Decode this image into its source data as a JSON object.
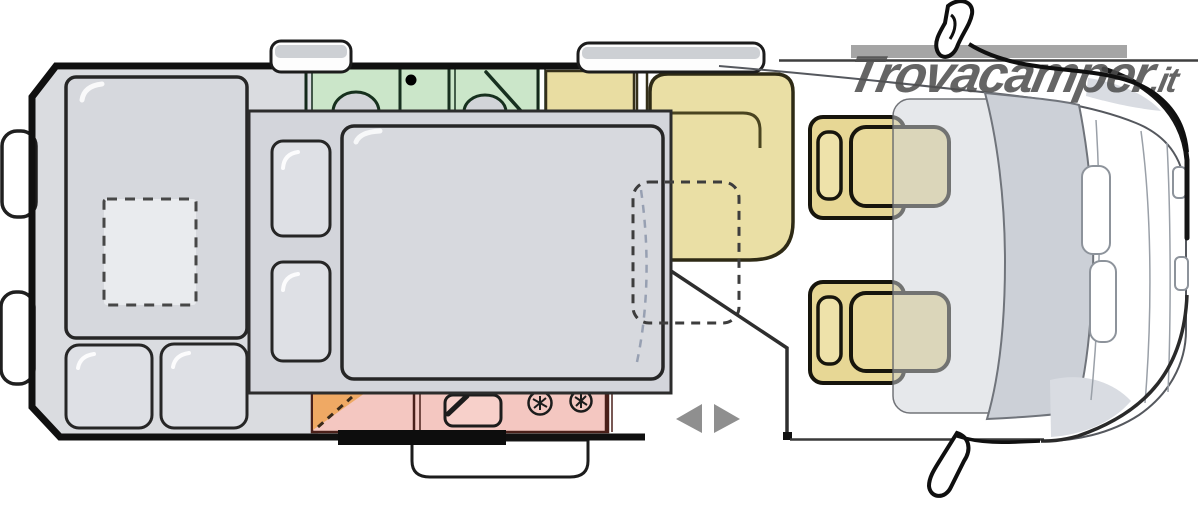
{
  "watermark": {
    "brand": "Trovacamper",
    "suffix": ".it"
  },
  "floorplan": {
    "kind": "motorhome-top-view-floorplan",
    "zones": [
      {
        "id": "rear-bed",
        "name": "rear transverse bed with roof vent"
      },
      {
        "id": "drop-down-bed",
        "name": "drop-down double bed (lowered, shown over living area)"
      },
      {
        "id": "bathroom",
        "name": "washroom with basin and shower"
      },
      {
        "id": "kitchen",
        "name": "kitchen block with sink and gas hob"
      },
      {
        "id": "dinette",
        "name": "front dinette bench with dashed table outline"
      },
      {
        "id": "entry-door",
        "name": "sliding entry door with step and direction arrows"
      },
      {
        "id": "cab",
        "name": "driver cab with two swivel seats"
      }
    ],
    "colors": {
      "body_outline": "#101010",
      "floor_gray": "#dadce0",
      "mattress_gray": "#d6d8dd",
      "overlay_bed_gray": "#d3d5db",
      "bathroom_green": "#cbe6c9",
      "dinette_yellow": "#eadfa5",
      "cab_seat_yellow": "#e7d795",
      "kitchen_pink": "#f4c7c1",
      "kitchen_orange": "#efa964",
      "door_arrow_gray": "#8f8f8f",
      "watermark_bar_gray": "#9b9b9b",
      "watermark_text_gray": "#4e4e4e"
    }
  }
}
